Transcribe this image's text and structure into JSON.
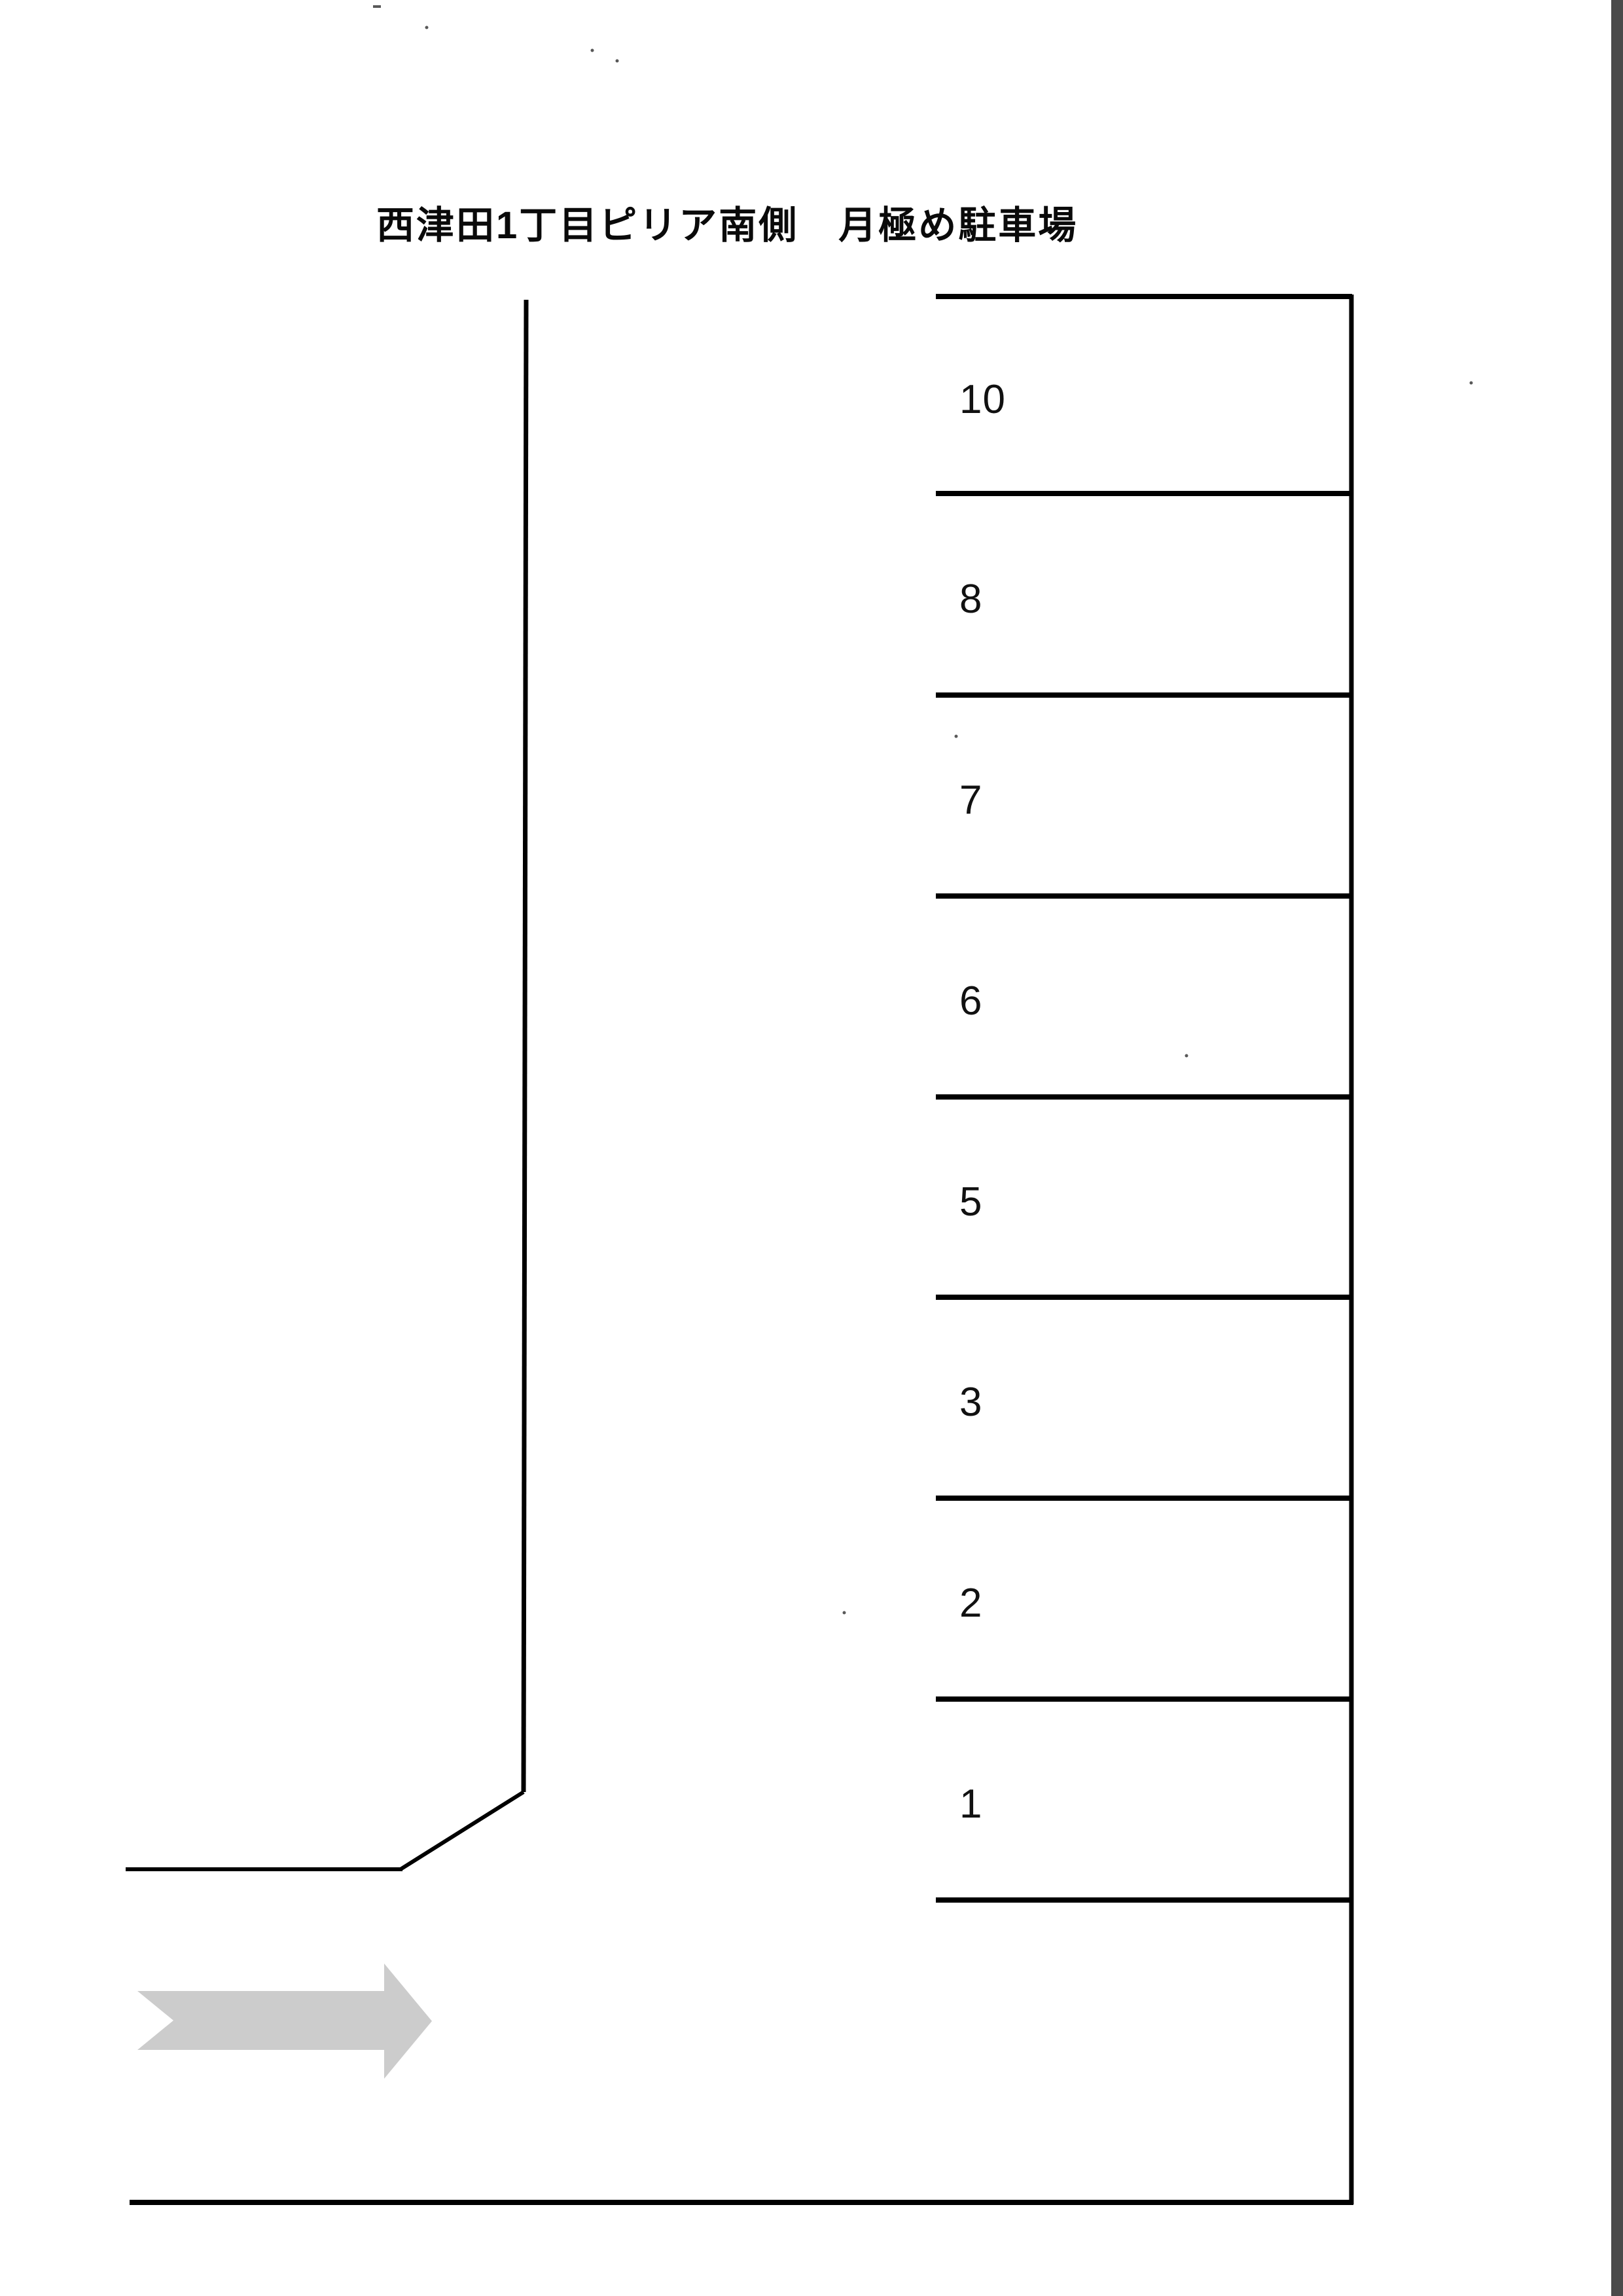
{
  "title": {
    "text": "西津田1丁目ピリア南側　月極め駐車場"
  },
  "parking": {
    "spaces": [
      "10",
      "8",
      "7",
      "6",
      "5",
      "3",
      "2",
      "1"
    ]
  },
  "arrow": {
    "direction": "right"
  },
  "colors": {
    "ink": "#000000",
    "paper": "#ffffff",
    "arrow_fill": "#cccccc",
    "scan_bar": "#4a4a4a"
  }
}
